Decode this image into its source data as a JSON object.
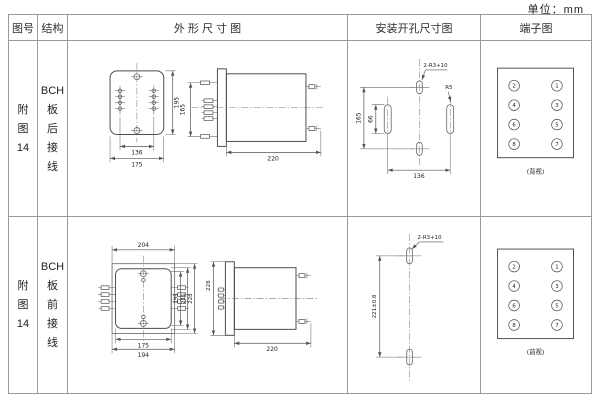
{
  "unit_label": "单位：mm",
  "header": {
    "figure_no": "图号",
    "structure": "结构",
    "outline": "外 形 尺 寸 图",
    "mounting": "安装开孔尺寸图",
    "terminal": "端子图"
  },
  "rows": [
    {
      "figure_no": [
        "附",
        "图",
        "14"
      ],
      "structure": [
        "BCH",
        "板",
        "后",
        "接",
        "线"
      ],
      "outline_dims": {
        "front_width_inner": "136",
        "front_width_outer": "175",
        "front_height": "195",
        "terminal_span": "165",
        "side_depth": "220"
      },
      "mounting_dims": {
        "hole_span": "165",
        "slot_length": "66",
        "slot_spacing": "136",
        "hole_label": "2-R3+10",
        "radius_label": "R5"
      },
      "terminals": {
        "left": [
          "2",
          "4",
          "6",
          "8"
        ],
        "right": [
          "1",
          "3",
          "5",
          "7"
        ],
        "caption": "(背视)"
      }
    },
    {
      "figure_no": [
        "附",
        "图",
        "14"
      ],
      "structure": [
        "BCH",
        "板",
        "前",
        "接",
        "线"
      ],
      "outline_dims": {
        "front_width_top": "204",
        "front_width_inner": "175",
        "front_width_outer": "194",
        "front_height_inner": "195",
        "front_height_mid": "211",
        "front_height_outer": "228",
        "side_depth": "220",
        "side_height": "228"
      },
      "mounting_dims": {
        "hole_spacing": "221±0.8",
        "hole_label": "2-R3+10"
      },
      "terminals": {
        "left": [
          "2",
          "4",
          "6",
          "8"
        ],
        "right": [
          "1",
          "3",
          "5",
          "7"
        ],
        "caption": "(前视)"
      }
    }
  ]
}
